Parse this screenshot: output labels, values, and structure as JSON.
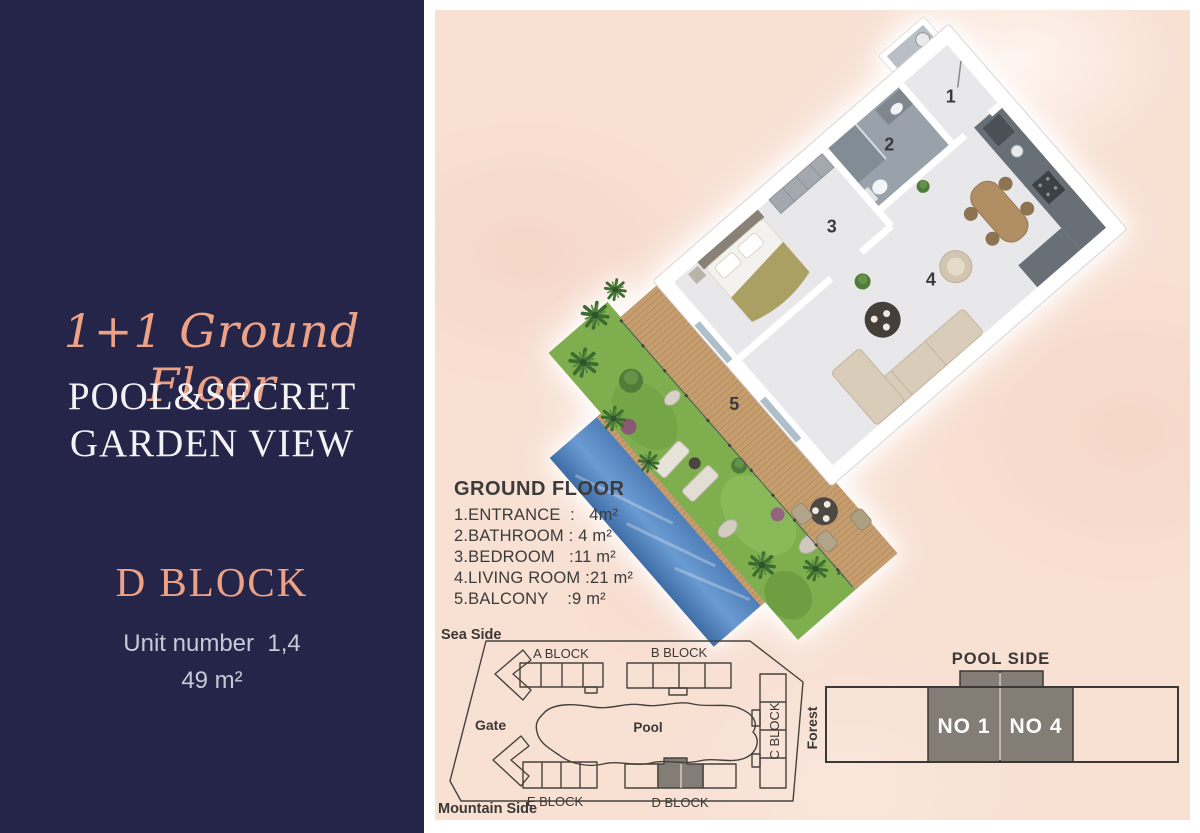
{
  "left_panel": {
    "title": "1+1 Ground Floor",
    "subtitle_line1": "POOL&SECRET",
    "subtitle_line2": "GARDEN VIEW",
    "block_name": "D BLOCK",
    "unit_number": "Unit number  1,4",
    "area": "49 m²"
  },
  "floor_plan": {
    "legend_title": "GROUND FLOOR",
    "legend_items": [
      "1.ENTRANCE  :   4m²",
      "2.BATHROOM : 4 m²",
      "3.BEDROOM   :11 m²",
      "4.LIVING ROOM :21 m²",
      "5.BALCONY    :9 m²"
    ],
    "room_numbers": {
      "entrance": "1",
      "bathroom": "2",
      "bedroom": "3",
      "living": "4",
      "balcony": "5"
    }
  },
  "site_plan": {
    "sea_side_label": "Sea Side",
    "mountain_side_label": "Mountain Side",
    "gate_label": "Gate",
    "pool_label": "Pool",
    "forest_label": "Forest",
    "block_a": "A BLOCK",
    "block_b": "B BLOCK",
    "block_c": "C BLOCK",
    "block_d": "D BLOCK",
    "block_e": "E BLOCK"
  },
  "unit_diagram": {
    "title": "POOL SIDE",
    "unit_1": "NO 1",
    "unit_4": "NO 4"
  },
  "colors": {
    "navy": "#242549",
    "peach_bg": "#f8e0d3",
    "salmon": "#eea285",
    "white_text": "#f5f2f3",
    "muted_text": "#c7c9d7",
    "plan_line": "#45423e",
    "highlight_unit": "#847d76",
    "pool_blue": "#5b8fc7",
    "grass_green": "#7fae4e",
    "deck_wood": "#c59d6e"
  }
}
